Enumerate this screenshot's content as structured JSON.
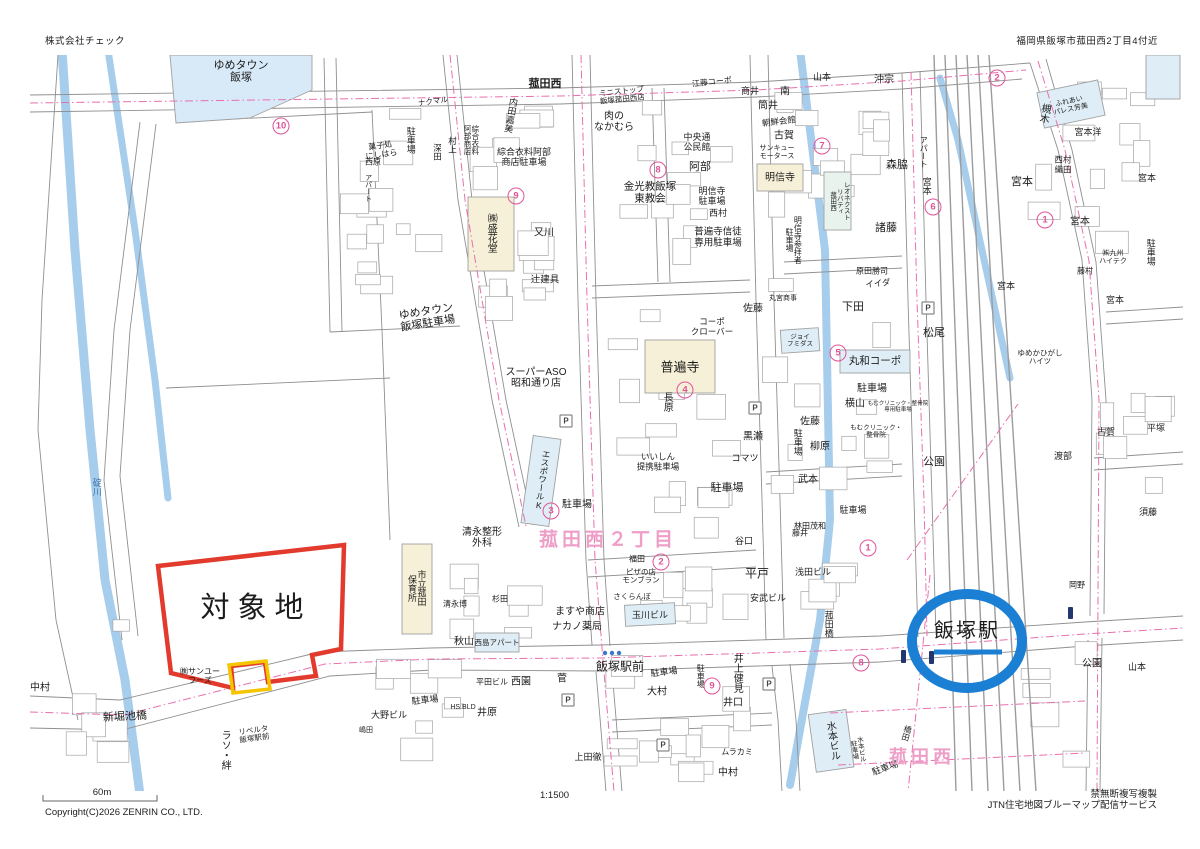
{
  "header": {
    "company": "株式会社チェック",
    "location": "福岡県飯塚市菰田西2丁目4付近"
  },
  "footer": {
    "scale_label": "60m",
    "scale_ratio": "1:1500",
    "notice": "禁無断複写複製",
    "service": "JTN住宅地図ブルーマップ配信サービス",
    "copyright": "Copyright(C)2026 ZENRIN CO., LTD."
  },
  "map": {
    "target_site": {
      "label": "対象地",
      "x": 256,
      "y": 608,
      "size": 29,
      "letter_spacing": 8
    },
    "station": {
      "label": "飯塚駅",
      "x": 967,
      "y": 631,
      "size": 20,
      "letter_spacing": 2
    },
    "district_labels": [
      {
        "text": "菰田西２丁目",
        "x": 608,
        "y": 540,
        "size": 19
      },
      {
        "text": "菰田西",
        "x": 922,
        "y": 757,
        "size": 18
      }
    ],
    "colors": {
      "river": "#a7cdec",
      "road": "#8f8f8f",
      "rail": "#9c9c9c",
      "pink": "#e86fae",
      "district_pink": "#ee9ec7",
      "badge_pink": "#e0549a",
      "target_red": "#e23b2e",
      "target_yellow": "#f5c500",
      "station_blue": "#1b7fd4",
      "temple_beige": "#f6f0d8",
      "building_cyan": "#dfeef6"
    },
    "parking_icon_letter": "P",
    "parking_icons": [
      [
        566,
        421
      ],
      [
        755,
        408
      ],
      [
        769,
        684
      ],
      [
        663,
        745
      ],
      [
        928,
        308
      ],
      [
        568,
        700
      ]
    ],
    "circled_numbers": [
      {
        "n": "10",
        "x": 281,
        "y": 126
      },
      {
        "n": "9",
        "x": 516,
        "y": 196
      },
      {
        "n": "8",
        "x": 658,
        "y": 170
      },
      {
        "n": "7",
        "x": 822,
        "y": 146
      },
      {
        "n": "6",
        "x": 933,
        "y": 207
      },
      {
        "n": "2",
        "x": 997,
        "y": 78
      },
      {
        "n": "1",
        "x": 1045,
        "y": 220
      },
      {
        "n": "5",
        "x": 838,
        "y": 353
      },
      {
        "n": "4",
        "x": 685,
        "y": 390
      },
      {
        "n": "3",
        "x": 551,
        "y": 511
      },
      {
        "n": "2",
        "x": 661,
        "y": 562
      },
      {
        "n": "1",
        "x": 868,
        "y": 548
      },
      {
        "n": "8",
        "x": 861,
        "y": 663
      },
      {
        "n": "9",
        "x": 712,
        "y": 686
      }
    ],
    "labels": [
      {
        "t": "ゆめタウン|飯塚",
        "x": 241,
        "y": 72,
        "s": 11
      },
      {
        "t": "菰田西",
        "x": 545,
        "y": 84,
        "s": 11,
        "w": 700
      },
      {
        "t": "ゆめタウン|飯塚駐車場",
        "x": 427,
        "y": 318,
        "s": 11,
        "r": -9
      },
      {
        "t": "碇川",
        "x": 96,
        "y": 487,
        "s": 9,
        "v": 1,
        "c": "#3f72a8"
      },
      {
        "t": "㈱サンユー|フーズ",
        "x": 200,
        "y": 677,
        "s": 8
      },
      {
        "t": "新堀池橋",
        "x": 125,
        "y": 717,
        "s": 11,
        "r": -3
      },
      {
        "t": "中村",
        "x": 40,
        "y": 688,
        "s": 10
      },
      {
        "t": "ラソ・絆",
        "x": 224,
        "y": 750,
        "s": 10,
        "v": 1
      },
      {
        "t": "リベルタ|飯塚駅前",
        "x": 254,
        "y": 735,
        "s": 7.5,
        "r": -8
      },
      {
        "t": "ナクマル",
        "x": 433,
        "y": 102,
        "s": 7.5,
        "r": -8
      },
      {
        "t": "駐車場",
        "x": 410,
        "y": 140,
        "s": 9,
        "v": 1
      },
      {
        "t": "菓子処|にしはら",
        "x": 381,
        "y": 151,
        "s": 8,
        "r": -8
      },
      {
        "t": "西原",
        "x": 373,
        "y": 163,
        "s": 8
      },
      {
        "t": "アパート",
        "x": 368,
        "y": 188,
        "s": 7,
        "v": 1
      },
      {
        "t": "深田",
        "x": 437,
        "y": 152,
        "s": 8.5,
        "v": 1
      },
      {
        "t": "村上",
        "x": 452,
        "y": 145,
        "s": 8.5,
        "v": 1
      },
      {
        "t": "内田嘉美",
        "x": 510,
        "y": 115,
        "s": 9,
        "v": 1,
        "r": 10
      },
      {
        "t": "綜合衣料|阿部商店",
        "x": 471,
        "y": 140,
        "s": 7.5,
        "v": 1
      },
      {
        "t": "綜合衣料阿部|商店駐車場",
        "x": 524,
        "y": 157,
        "s": 9
      },
      {
        "t": "㈱盛花堂",
        "x": 490,
        "y": 233,
        "s": 10,
        "v": 1
      },
      {
        "t": "又川",
        "x": 544,
        "y": 233,
        "s": 10
      },
      {
        "t": "辻建具",
        "x": 545,
        "y": 281,
        "s": 9.5
      },
      {
        "t": "ミニストップ|飯塚菰田西店",
        "x": 622,
        "y": 96,
        "s": 7.5,
        "r": -6
      },
      {
        "t": "肉の|なかむら",
        "x": 614,
        "y": 122,
        "s": 10
      },
      {
        "t": "金光教飯塚|東教会",
        "x": 650,
        "y": 193,
        "s": 10.5
      },
      {
        "t": "阿部",
        "x": 700,
        "y": 167,
        "s": 11
      },
      {
        "t": "中央通|公民館",
        "x": 697,
        "y": 142,
        "s": 9
      },
      {
        "t": "江藤コーポ",
        "x": 712,
        "y": 83,
        "s": 8,
        "r": -6
      },
      {
        "t": "明信寺|駐車場",
        "x": 712,
        "y": 196,
        "s": 9
      },
      {
        "t": "西村",
        "x": 718,
        "y": 213,
        "s": 9
      },
      {
        "t": "普遍寺信徒|専用駐車場",
        "x": 718,
        "y": 238,
        "s": 9.5
      },
      {
        "t": "商井",
        "x": 750,
        "y": 91,
        "s": 9
      },
      {
        "t": "南",
        "x": 785,
        "y": 92,
        "s": 10
      },
      {
        "t": "筒井",
        "x": 768,
        "y": 106,
        "s": 10
      },
      {
        "t": "朝鮮会館",
        "x": 779,
        "y": 122,
        "s": 8.5,
        "r": -7
      },
      {
        "t": "古賀",
        "x": 784,
        "y": 136,
        "s": 10
      },
      {
        "t": "サンキュー|モータース",
        "x": 777,
        "y": 153,
        "s": 7
      },
      {
        "t": "明信寺",
        "x": 780,
        "y": 178,
        "s": 10
      },
      {
        "t": "明信寺参拝者|駐車場",
        "x": 793,
        "y": 240,
        "s": 8,
        "v": 1
      },
      {
        "t": "山本",
        "x": 822,
        "y": 77,
        "s": 9
      },
      {
        "t": "沖宗",
        "x": 884,
        "y": 80,
        "s": 10
      },
      {
        "t": "森脇",
        "x": 897,
        "y": 165,
        "s": 11
      },
      {
        "t": "諸藤",
        "x": 886,
        "y": 228,
        "s": 11
      },
      {
        "t": "レオネクスト|リバティ|菰田西",
        "x": 838,
        "y": 201,
        "s": 6.5,
        "v": 1
      },
      {
        "t": "原田勝司",
        "x": 872,
        "y": 272,
        "s": 8
      },
      {
        "t": "イイダ",
        "x": 878,
        "y": 284,
        "s": 8.5,
        "r": -6
      },
      {
        "t": "下田",
        "x": 853,
        "y": 307,
        "s": 11
      },
      {
        "t": "丸和コーポ",
        "x": 875,
        "y": 362,
        "s": 10.5
      },
      {
        "t": "駐車場",
        "x": 872,
        "y": 389,
        "s": 10
      },
      {
        "t": "横山",
        "x": 855,
        "y": 404,
        "s": 10
      },
      {
        "t": "もむクリニック・整骨院|専用駐車場",
        "x": 898,
        "y": 407,
        "s": 5.5
      },
      {
        "t": "もむクリニック・|整骨院",
        "x": 876,
        "y": 432,
        "s": 6.5
      },
      {
        "t": "松尾",
        "x": 934,
        "y": 333,
        "s": 11
      },
      {
        "t": "公園",
        "x": 934,
        "y": 462,
        "s": 11
      },
      {
        "t": "公園",
        "x": 1092,
        "y": 664,
        "s": 10
      },
      {
        "t": "佐藤",
        "x": 753,
        "y": 309,
        "s": 10
      },
      {
        "t": "コーポ|クローバー",
        "x": 712,
        "y": 327,
        "s": 8.5
      },
      {
        "t": "丸宮商事",
        "x": 783,
        "y": 299,
        "s": 7
      },
      {
        "t": "ジョイ|フミダス",
        "x": 800,
        "y": 341,
        "s": 6.5
      },
      {
        "t": "普遍寺",
        "x": 680,
        "y": 368,
        "s": 13
      },
      {
        "t": "長原",
        "x": 666,
        "y": 402,
        "s": 10,
        "v": 1
      },
      {
        "t": "黒瀬",
        "x": 753,
        "y": 437,
        "s": 10
      },
      {
        "t": "コマツ",
        "x": 745,
        "y": 458,
        "s": 9
      },
      {
        "t": "駐車場",
        "x": 797,
        "y": 442,
        "s": 9,
        "v": 1
      },
      {
        "t": "佐藤",
        "x": 810,
        "y": 422,
        "s": 10
      },
      {
        "t": "柳原",
        "x": 820,
        "y": 447,
        "s": 10
      },
      {
        "t": "武本",
        "x": 808,
        "y": 480,
        "s": 10
      },
      {
        "t": "いいしん|提携駐車場",
        "x": 658,
        "y": 462,
        "s": 8.5
      },
      {
        "t": "駐車場",
        "x": 727,
        "y": 488,
        "s": 11
      },
      {
        "t": "谷口",
        "x": 744,
        "y": 541,
        "s": 9
      },
      {
        "t": "藤井",
        "x": 800,
        "y": 534,
        "s": 8
      },
      {
        "t": "駐車場",
        "x": 853,
        "y": 510,
        "s": 9
      },
      {
        "t": "スーパーASO|昭和通り店",
        "x": 536,
        "y": 378,
        "s": 10
      },
      {
        "t": "エスポワールK",
        "x": 542,
        "y": 480,
        "s": 8.5,
        "v": 1,
        "r": 8
      },
      {
        "t": "駐車場",
        "x": 577,
        "y": 505,
        "s": 10
      },
      {
        "t": "清永整形|外科",
        "x": 482,
        "y": 538,
        "s": 10
      },
      {
        "t": "市立菰田|保育所",
        "x": 416,
        "y": 588,
        "s": 9,
        "v": 1
      },
      {
        "t": "清永博",
        "x": 455,
        "y": 605,
        "s": 8
      },
      {
        "t": "杉田",
        "x": 500,
        "y": 600,
        "s": 8
      },
      {
        "t": "秋山",
        "x": 464,
        "y": 642,
        "s": 10
      },
      {
        "t": "西島アパート",
        "x": 497,
        "y": 643,
        "s": 7.5
      },
      {
        "t": "ますや商店",
        "x": 580,
        "y": 612,
        "s": 10
      },
      {
        "t": "ナカノ薬局",
        "x": 577,
        "y": 627,
        "s": 10
      },
      {
        "t": "玉川ビル",
        "x": 650,
        "y": 615,
        "s": 9
      },
      {
        "t": "さくらんぼ",
        "x": 632,
        "y": 597,
        "s": 7.5
      },
      {
        "t": "ピザの店|モンブラン",
        "x": 641,
        "y": 577,
        "s": 7.5
      },
      {
        "t": "福田",
        "x": 637,
        "y": 560,
        "s": 8
      },
      {
        "t": "平戸",
        "x": 757,
        "y": 574,
        "s": 12
      },
      {
        "t": "安武ビル",
        "x": 768,
        "y": 598,
        "s": 9
      },
      {
        "t": "浅田ビル",
        "x": 813,
        "y": 572,
        "s": 9
      },
      {
        "t": "林田茂和",
        "x": 810,
        "y": 527,
        "s": 8
      },
      {
        "t": "菰田橋",
        "x": 828,
        "y": 624,
        "s": 9,
        "v": 1
      },
      {
        "t": "飯塚駅前",
        "x": 620,
        "y": 667,
        "s": 12
      },
      {
        "t": "駐車場",
        "x": 664,
        "y": 672,
        "s": 9,
        "r": -7
      },
      {
        "t": "駐車場",
        "x": 700,
        "y": 676,
        "s": 8,
        "v": 1
      },
      {
        "t": "大村",
        "x": 657,
        "y": 692,
        "s": 10
      },
      {
        "t": "井上健見",
        "x": 736,
        "y": 673,
        "s": 10,
        "v": 1
      },
      {
        "t": "井口",
        "x": 733,
        "y": 703,
        "s": 10
      },
      {
        "t": "ムラカミ",
        "x": 737,
        "y": 753,
        "s": 8
      },
      {
        "t": "中村",
        "x": 728,
        "y": 773,
        "s": 10
      },
      {
        "t": "水本ビル",
        "x": 831,
        "y": 741,
        "s": 10,
        "v": 1,
        "r": -8
      },
      {
        "t": "水本ビル|駐車場",
        "x": 856,
        "y": 750,
        "s": 6.5,
        "v": 1,
        "r": -8
      },
      {
        "t": "駐車場",
        "x": 885,
        "y": 768,
        "s": 9,
        "r": -20
      },
      {
        "t": "橋田",
        "x": 906,
        "y": 733,
        "s": 8,
        "v": 1,
        "r": 15
      },
      {
        "t": "上田徹",
        "x": 588,
        "y": 757,
        "s": 9
      },
      {
        "t": "嶋田",
        "x": 366,
        "y": 731,
        "s": 7
      },
      {
        "t": "大野ビル",
        "x": 389,
        "y": 715,
        "s": 9
      },
      {
        "t": "駐車場",
        "x": 425,
        "y": 700,
        "s": 9,
        "r": -6
      },
      {
        "t": "HS.BLD",
        "x": 463,
        "y": 708,
        "s": 7
      },
      {
        "t": "井原",
        "x": 487,
        "y": 713,
        "s": 10
      },
      {
        "t": "平田ビル",
        "x": 492,
        "y": 683,
        "s": 8
      },
      {
        "t": "西園",
        "x": 521,
        "y": 682,
        "s": 10
      },
      {
        "t": "菅",
        "x": 562,
        "y": 679,
        "s": 10
      },
      {
        "t": "岡野",
        "x": 1077,
        "y": 586,
        "s": 8
      },
      {
        "t": "山本",
        "x": 1137,
        "y": 667,
        "s": 9
      },
      {
        "t": "須藤",
        "x": 1148,
        "y": 512,
        "s": 9
      },
      {
        "t": "渡部",
        "x": 1063,
        "y": 456,
        "s": 9
      },
      {
        "t": "古賀",
        "x": 1106,
        "y": 432,
        "s": 9
      },
      {
        "t": "平塚",
        "x": 1156,
        "y": 428,
        "s": 9
      },
      {
        "t": "ゆめかひがし|ハイツ",
        "x": 1040,
        "y": 358,
        "s": 7.5
      },
      {
        "t": "槻木",
        "x": 1043,
        "y": 113,
        "s": 10,
        "v": 1,
        "r": 10
      },
      {
        "t": "宮本洋",
        "x": 1088,
        "y": 132,
        "s": 9
      },
      {
        "t": "西村|織田",
        "x": 1063,
        "y": 165,
        "s": 8.5
      },
      {
        "t": "宮本",
        "x": 1022,
        "y": 182,
        "s": 11
      },
      {
        "t": "宮本",
        "x": 1080,
        "y": 222,
        "s": 10
      },
      {
        "t": "宮本",
        "x": 1147,
        "y": 178,
        "s": 9
      },
      {
        "t": "宮本",
        "x": 1006,
        "y": 286,
        "s": 9
      },
      {
        "t": "宮本",
        "x": 1115,
        "y": 300,
        "s": 9
      },
      {
        "t": "藤村",
        "x": 1085,
        "y": 272,
        "s": 8
      },
      {
        "t": "㈱九州|ハイテク",
        "x": 1113,
        "y": 258,
        "s": 7
      },
      {
        "t": "駐車場",
        "x": 1150,
        "y": 252,
        "s": 9,
        "v": 1
      },
      {
        "t": "アパート",
        "x": 923,
        "y": 152,
        "s": 8,
        "v": 1
      },
      {
        "t": "宮本",
        "x": 926,
        "y": 186,
        "s": 9,
        "v": 1
      },
      {
        "t": "ふれあい|パレス芳美",
        "x": 1070,
        "y": 106,
        "s": 7,
        "r": -12
      }
    ]
  }
}
